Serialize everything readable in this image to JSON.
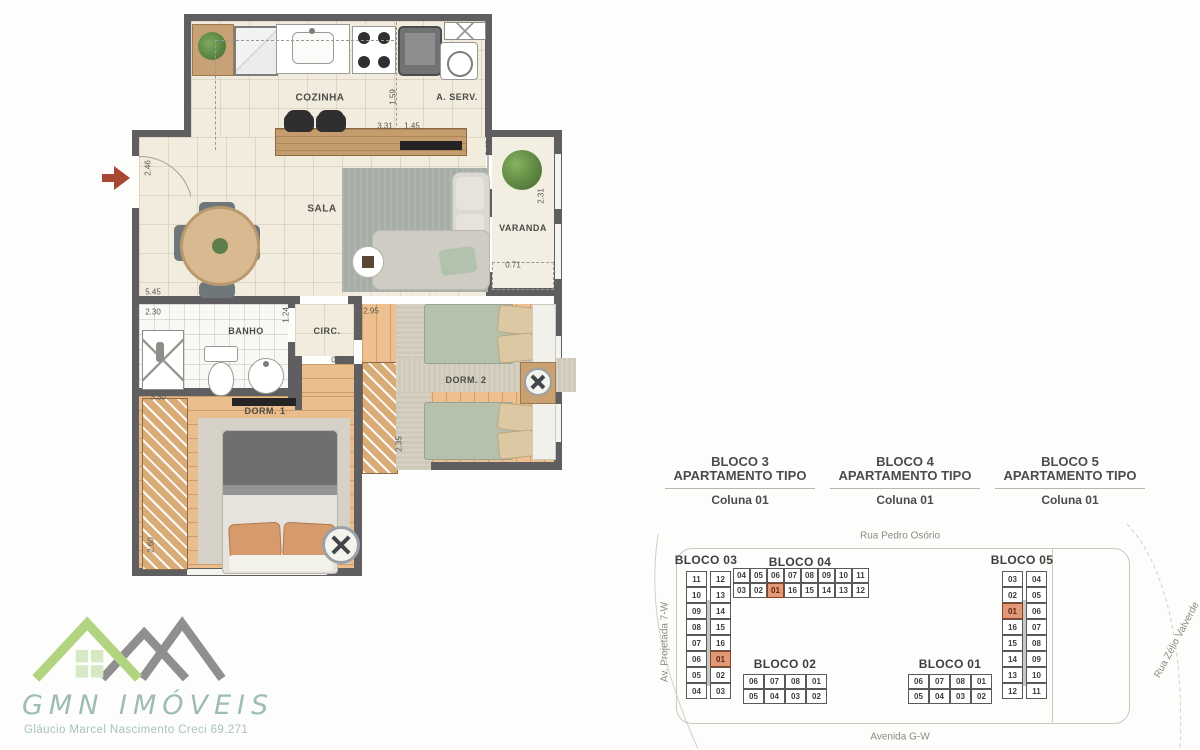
{
  "floor_plan": {
    "rooms": {
      "cozinha": "COZINHA",
      "aserv": "A. SERV.",
      "sala": "SALA",
      "varanda": "VARANDA",
      "banho": "BANHO",
      "circ": "CIRC.",
      "dorm1": "DORM. 1",
      "dorm2": "DORM. 2"
    },
    "dims": {
      "entry_side": "2.46",
      "kitchen_depth": "1.59",
      "kitchen_width": "3.31",
      "aserv_width": "1.45",
      "varanda_top": "2.40",
      "varanda_side": "2.31",
      "varanda_bottom": "0.71",
      "sala_width": "5.45",
      "banho_width": "2.30",
      "banho_depth": "1.24",
      "dorm2_width": "2.95",
      "circ_door": "0.90",
      "dorm1_width": "3.30",
      "dorm2_depth": "2.35",
      "dorm1_depth": "2.60"
    }
  },
  "headers": [
    {
      "block": "BLOCO 3",
      "type": "APARTAMENTO TIPO",
      "column": "Coluna 01"
    },
    {
      "block": "BLOCO 4",
      "type": "APARTAMENTO TIPO",
      "column": "Coluna 01"
    },
    {
      "block": "BLOCO 5",
      "type": "APARTAMENTO TIPO",
      "column": "Coluna 01"
    }
  ],
  "site_plan": {
    "streets": {
      "top": "Rua Pedro Osório",
      "bottom": "Avenida G-W",
      "left": "Av. Projetada 7-W",
      "right": "Rua Zélio Valverde"
    },
    "blocks": {
      "bloco03": {
        "label": "BLOCO 03",
        "highlight": "01",
        "rows": [
          [
            "11",
            "12"
          ],
          [
            "10",
            "13"
          ],
          [
            "09",
            "14"
          ],
          [
            "08",
            "15"
          ],
          [
            "07",
            "16"
          ],
          [
            "06",
            "01"
          ],
          [
            "05",
            "02"
          ],
          [
            "04",
            "03"
          ]
        ]
      },
      "bloco04": {
        "label": "BLOCO 04",
        "highlight": "01",
        "rows": [
          [
            "04",
            "05",
            "06",
            "07",
            "08",
            "09",
            "10",
            "11"
          ],
          [
            "03",
            "02",
            "01",
            "16",
            "15",
            "14",
            "13",
            "12"
          ]
        ]
      },
      "bloco05": {
        "label": "BLOCO 05",
        "highlight": "01",
        "rows": [
          [
            "03",
            "04"
          ],
          [
            "02",
            "05"
          ],
          [
            "01",
            "06"
          ],
          [
            "16",
            "07"
          ],
          [
            "15",
            "08"
          ],
          [
            "14",
            "09"
          ],
          [
            "13",
            "10"
          ],
          [
            "12",
            "11"
          ]
        ]
      },
      "bloco02": {
        "label": "BLOCO 02",
        "highlight": null,
        "rows": [
          [
            "06",
            "07",
            "08",
            "01"
          ],
          [
            "05",
            "04",
            "03",
            "02"
          ]
        ]
      },
      "bloco01": {
        "label": "BLOCO 01",
        "highlight": null,
        "rows": [
          [
            "06",
            "07",
            "08",
            "01"
          ],
          [
            "05",
            "04",
            "03",
            "02"
          ]
        ]
      }
    }
  },
  "logo": {
    "brand": "GMN IMÓVEIS",
    "tagline": "Gláucio Marcel Nascimento   Creci 69.271"
  },
  "colors": {
    "highlight_unit": "#e09a7a",
    "wall": "#5f5f61",
    "wood_floor": "#eabd8c",
    "tile_floor": "#f1ecdd",
    "logo_green": "#b2d37f",
    "logo_gray": "#8f8f8f",
    "logo_text": "#9dbdb1",
    "entry_arrow": "#a84732"
  }
}
